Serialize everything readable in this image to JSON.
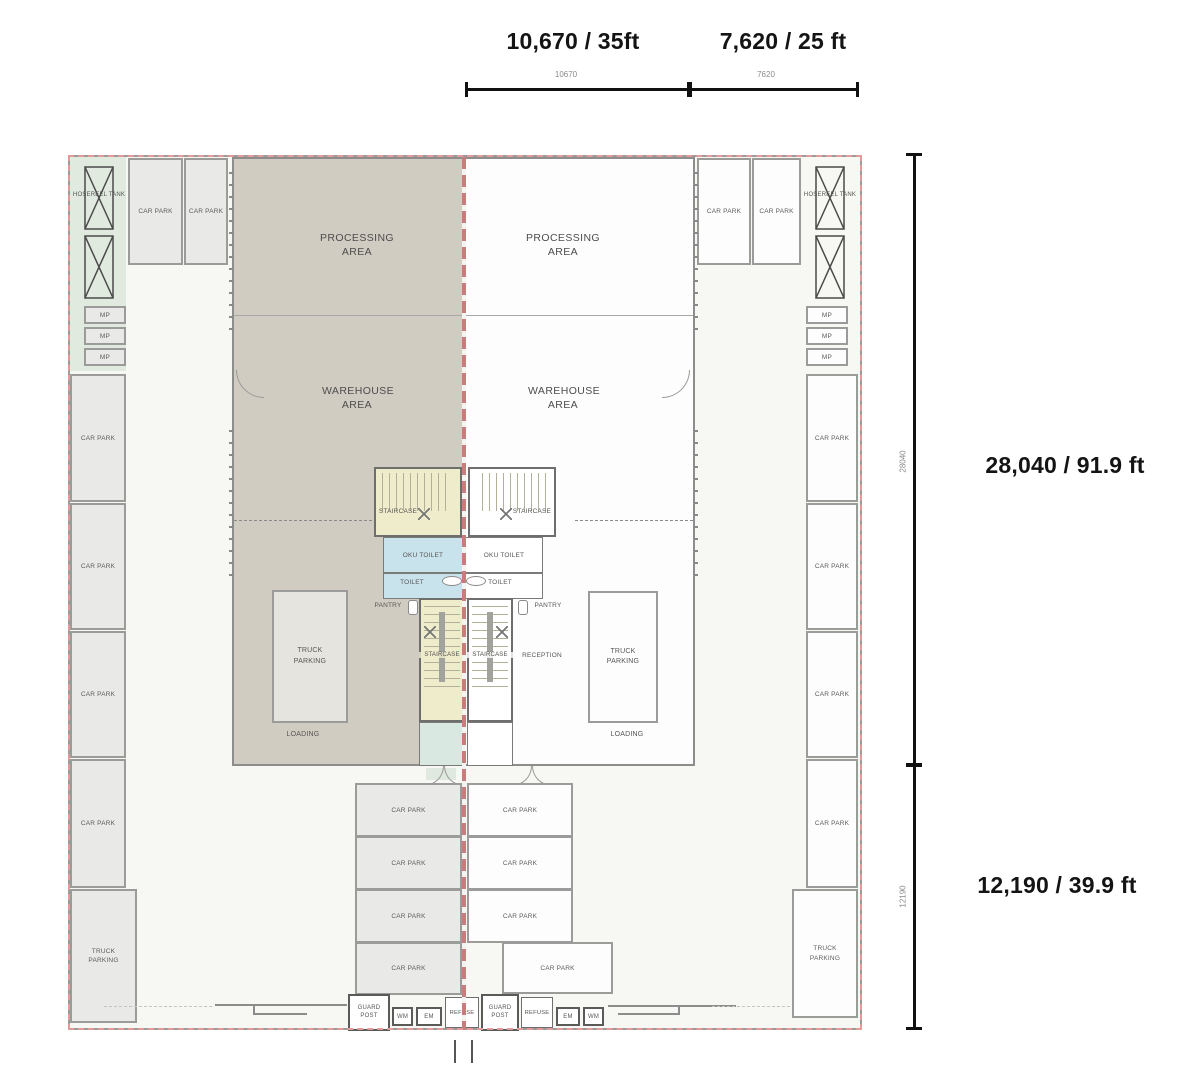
{
  "dimensions": {
    "top": [
      {
        "bold": "10,670 / 35ft",
        "tick": "10670"
      },
      {
        "bold": "7,620 / 25 ft",
        "tick": "7620"
      }
    ],
    "right": [
      {
        "bold": "28,040 / 91.9 ft",
        "tick": "28040"
      },
      {
        "bold": "12,190 / 39.9 ft",
        "tick": "12190"
      }
    ]
  },
  "rooms": {
    "processing_area": "PROCESSING AREA",
    "warehouse_area": "WAREHOUSE AREA",
    "staircase": "STAIRCASE",
    "oku_toilet": "OKU TOILET",
    "toilet": "TOILET",
    "pantry": "PANTRY",
    "reception": "RECEPTION",
    "loading": "LOADING",
    "truck_parking": "TRUCK PARKING",
    "car_park": "CAR PARK",
    "hosereel_tank": "HOSEREEL TANK",
    "mp": "MP",
    "guard_post": "GUARD POST",
    "wm": "WM",
    "em": "EM",
    "refuse": "REFUSE"
  },
  "colors": {
    "left_unit_fill": "#d0ccc2",
    "stall_fill": "#e9e9e7",
    "green_strip": "#e0eadf",
    "stair_fill": "#efeccb",
    "toilet_fill": "#c9e3ed",
    "lobby_fill": "#d9e8e0",
    "party_wall_red": "#c97c7c",
    "boundary_red": "#e39a9a",
    "wall_grey": "#8d8d8b"
  }
}
